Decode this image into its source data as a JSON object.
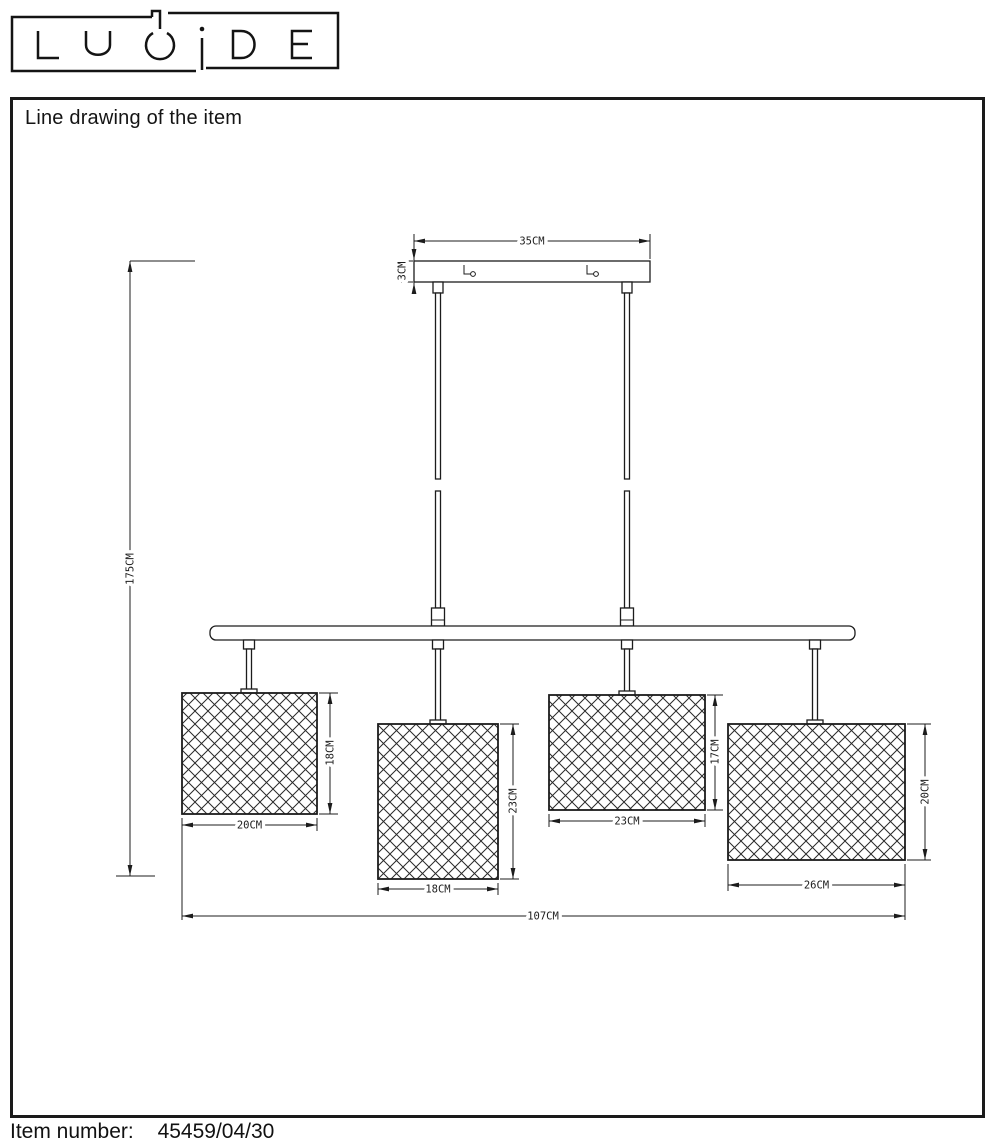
{
  "brand": {
    "name": "LUCIDE"
  },
  "panel": {
    "title": "Line drawing of the item"
  },
  "drawing": {
    "canopy": {
      "width_label": "35CM",
      "height_label": "3CM"
    },
    "overall": {
      "height_label": "175CM",
      "width_label": "107CM"
    },
    "shades": [
      {
        "width_label": "20CM",
        "height_label": "18CM"
      },
      {
        "width_label": "18CM",
        "height_label": "23CM"
      },
      {
        "width_label": "23CM",
        "height_label": "17CM"
      },
      {
        "width_label": "26CM",
        "height_label": "20CM"
      }
    ],
    "colors": {
      "line": "#1c1c1c",
      "background": "#ffffff"
    }
  },
  "footer": {
    "item_number_label": "Item number:",
    "item_number": "45459/04/30"
  }
}
